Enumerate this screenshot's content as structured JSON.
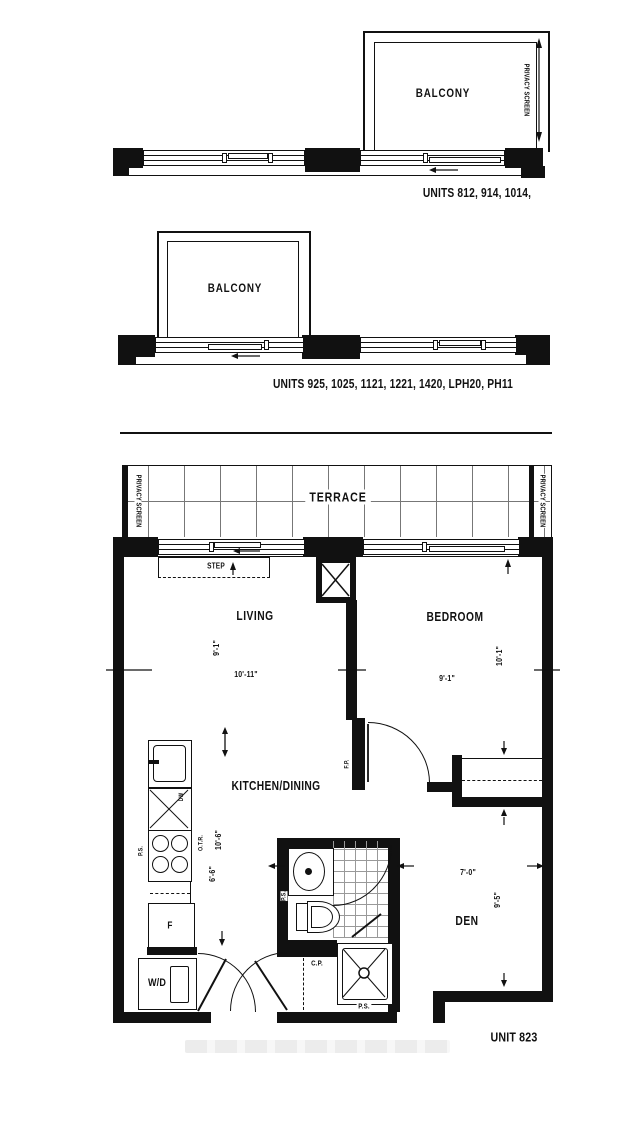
{
  "colors": {
    "ink": "#111111",
    "terrace_grid": "#777777",
    "tile_grid": "#999999",
    "watermark": "#ececec"
  },
  "diagrams": [
    {
      "balcony_label": "BALCONY",
      "privacy_screen": "PRIVACY SCREEN",
      "caption": "UNITS 812, 914, 1014,"
    },
    {
      "balcony_label": "BALCONY",
      "caption": "UNITS 925, 1025, 1121, 1221, 1420, LPH20, PH11"
    }
  ],
  "floor_plan": {
    "unit_label": "UNIT 823",
    "terrace": {
      "label": "TERRACE",
      "privacy_screen_left": "PRIVACY SCREEN",
      "privacy_screen_right": "PRIVACY SCREEN",
      "step_label": "STEP"
    },
    "rooms": {
      "living": {
        "label": "LIVING",
        "width": "10'-11\"",
        "depth": "9'-1\""
      },
      "bedroom": {
        "label": "BEDROOM",
        "width": "9'-1\"",
        "depth": "10'-1\""
      },
      "kitchen_dining": {
        "label": "KITCHEN/DINING",
        "width": "6'-6\"",
        "depth": "10'-6\""
      },
      "den": {
        "label": "DEN",
        "width": "7'-0\"",
        "depth": "9'-5\""
      }
    },
    "fixtures": {
      "fridge": "F",
      "washer_dryer": "W/D",
      "dishwasher": "DW"
    },
    "tags": {
      "ps": "P.S.",
      "otr": "O.T.R.",
      "cp": "C.P.",
      "fp": "F.P."
    }
  }
}
